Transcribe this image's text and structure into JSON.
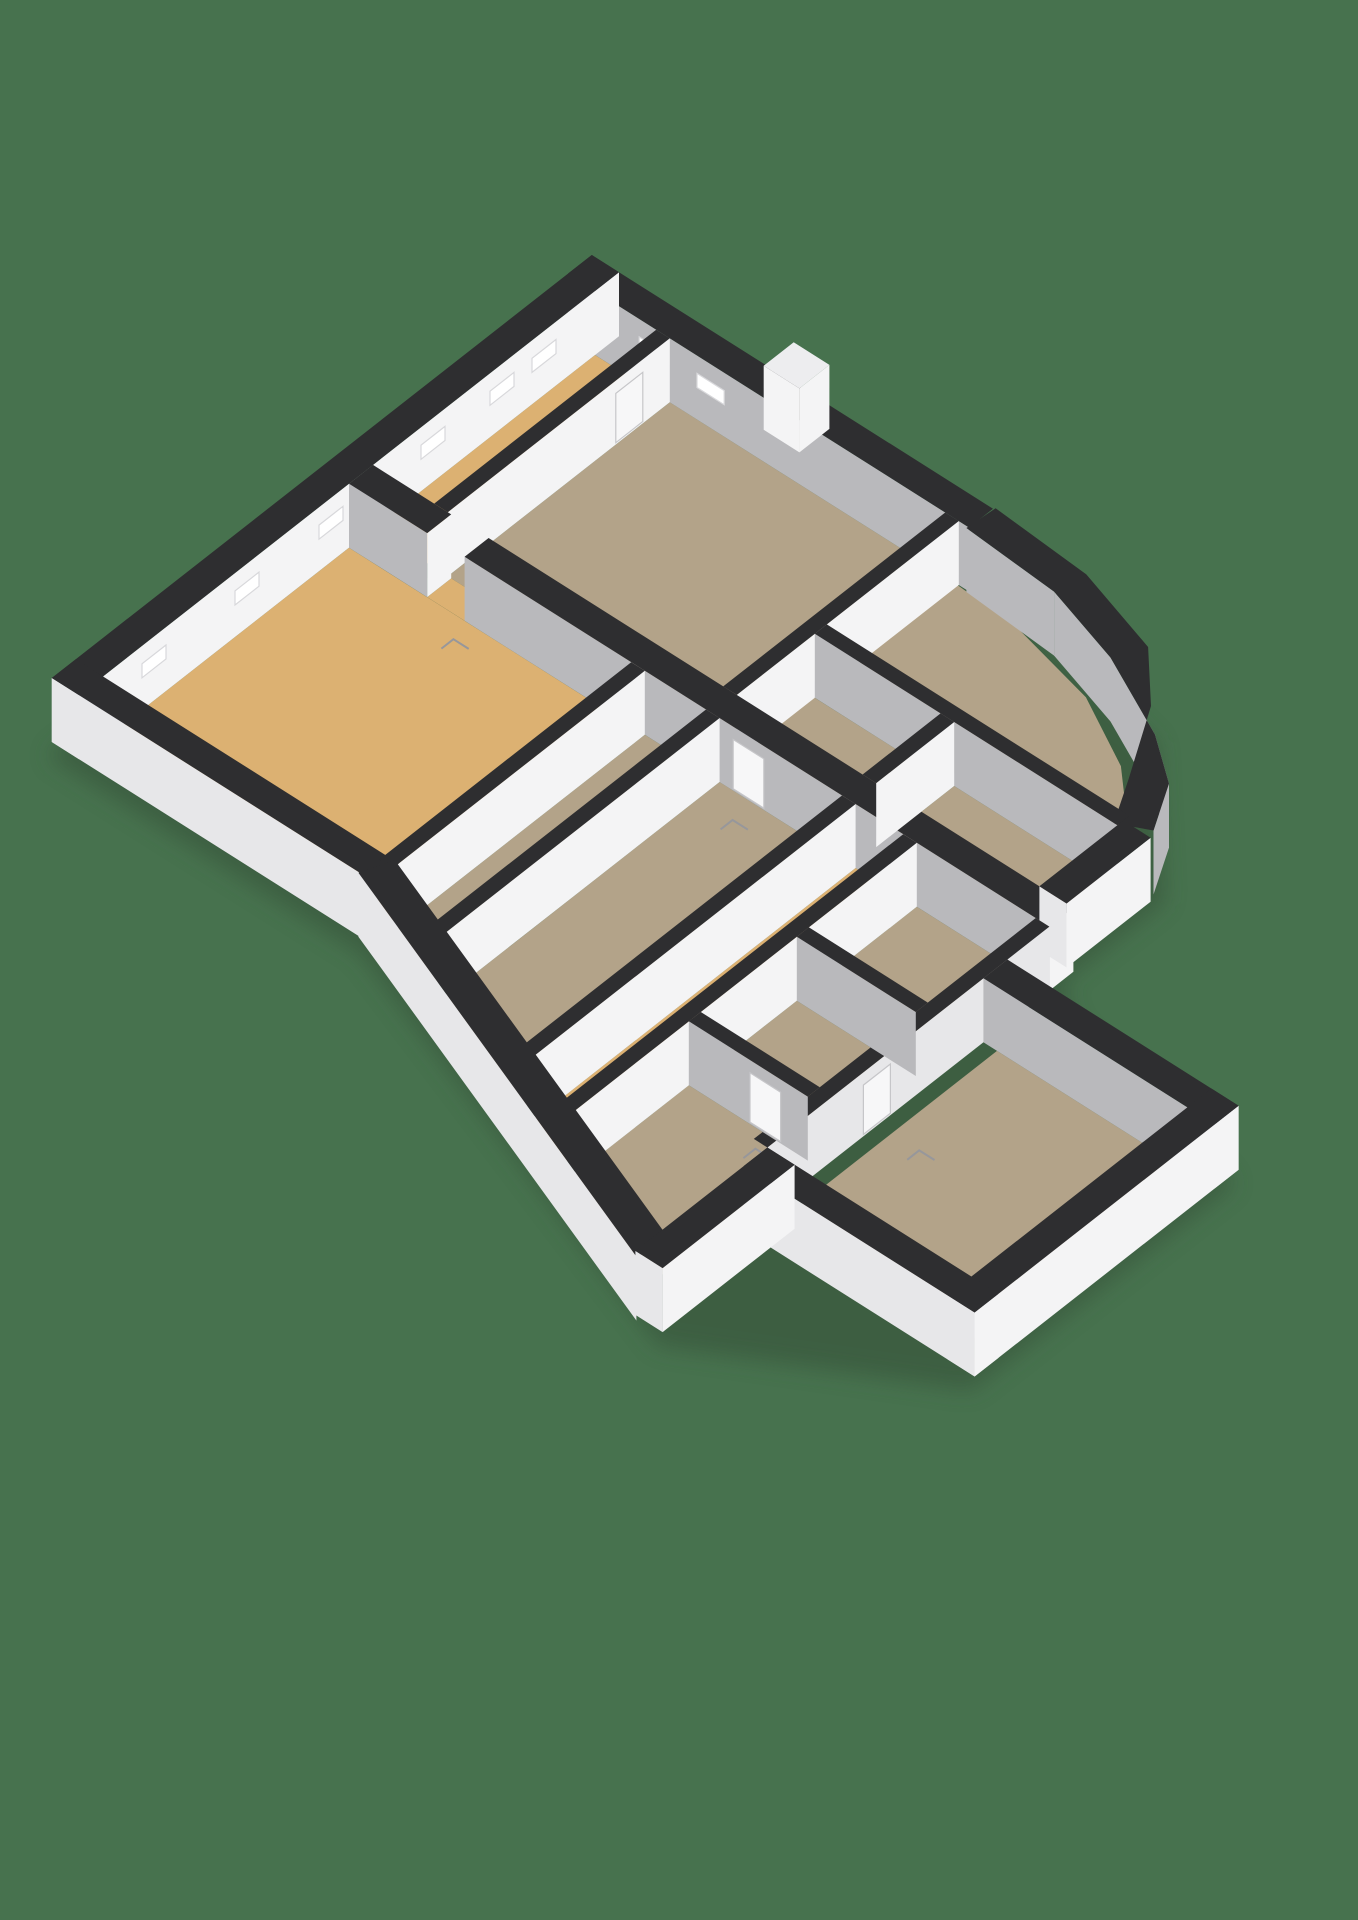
{
  "scene": {
    "description": "3D axonometric floor plan render on plain green background",
    "background_color": "#47724E",
    "shadow_color": "#344F39"
  },
  "palette": {
    "wall_cap": "#2E2E30",
    "wall_white": "#F4F4F5",
    "wall_exterior_light": "#E7E7E9",
    "wall_gray_inner": "#B9B9BC",
    "floor_tan": "#B3A389",
    "floor_gold": "#DCB172",
    "window_fill": "#FFFFFF",
    "window_stroke": "#D8D8DB",
    "door_fill": "#F7F7F8",
    "door_stroke": "#C6C6C9",
    "swing_mark": "#97979B",
    "fixture_fill": "#FCFCFC",
    "fixture_stroke": "#DCDCDE",
    "door_leaf_cap": "#EDEDEF"
  },
  "projection": {
    "origin": [
      595,
      355
    ],
    "axis_a": [
      34,
      21.5
    ],
    "axis_b": [
      -30,
      23.5
    ],
    "wall_height": 64,
    "shadow_offset": [
      -4,
      14
    ]
  },
  "shadow_footprint": [
    [
      -0.8,
      -0.8
    ],
    [
      11,
      -0.8
    ],
    [
      17,
      0.4
    ],
    [
      20.4,
      4
    ],
    [
      20.4,
      7.4
    ],
    [
      21.4,
      8.2
    ],
    [
      27.4,
      9.6
    ],
    [
      27.4,
      18.4
    ],
    [
      21.4,
      22.0
    ],
    [
      8.4,
      17.2
    ],
    [
      -0.8,
      17.2
    ]
  ],
  "floors": [
    {
      "name": "room-top-left",
      "color": "floor_gold",
      "pts": [
        [
          0,
          0
        ],
        [
          1.8,
          0
        ],
        [
          1.8,
          7.4
        ],
        [
          0,
          7.4
        ]
      ]
    },
    {
      "name": "room-top-center",
      "color": "floor_tan",
      "pts": [
        [
          2.2,
          0
        ],
        [
          10.4,
          0
        ],
        [
          10.4,
          7.4
        ],
        [
          2.2,
          7.4
        ]
      ]
    },
    {
      "name": "room-top-right",
      "color": "floor_tan",
      "pts": [
        [
          10.4,
          0
        ],
        [
          12.6,
          0.15
        ],
        [
          15.1,
          0.75
        ],
        [
          17.1,
          1.85
        ],
        [
          18.5,
          3.2
        ],
        [
          19.2,
          4.6
        ],
        [
          10.4,
          4.6
        ]
      ]
    },
    {
      "name": "room-upper-small-left",
      "color": "floor_tan",
      "pts": [
        [
          10.4,
          4.8
        ],
        [
          14.4,
          4.8
        ],
        [
          14.4,
          7.4
        ],
        [
          10.4,
          7.4
        ]
      ]
    },
    {
      "name": "room-upper-small-right",
      "color": "floor_tan",
      "pts": [
        [
          14.8,
          4.8
        ],
        [
          19.6,
          4.8
        ],
        [
          19.6,
          7.4
        ],
        [
          14.8,
          7.4
        ]
      ]
    },
    {
      "name": "door-gap-floor",
      "color": "floor_gold",
      "pts": [
        [
          2.3,
          7.4
        ],
        [
          3.4,
          7.4
        ],
        [
          3.4,
          8.2
        ],
        [
          2.3,
          8.2
        ]
      ]
    },
    {
      "name": "room-living-gold",
      "color": "floor_gold",
      "pts": [
        [
          0,
          8.2
        ],
        [
          8.5,
          8.2
        ],
        [
          8.5,
          16.5
        ],
        [
          0,
          16.5
        ]
      ]
    },
    {
      "name": "hall-strip",
      "color": "floor_tan",
      "pts": [
        [
          8.7,
          8.2
        ],
        [
          10.5,
          8.2
        ],
        [
          10.5,
          17.2
        ],
        [
          8.7,
          16.5
        ]
      ]
    },
    {
      "name": "room-long-strip",
      "color": "floor_tan",
      "pts": [
        [
          10.9,
          8.2
        ],
        [
          14.5,
          8.2
        ],
        [
          14.5,
          18.8
        ],
        [
          10.9,
          17.4
        ]
      ]
    },
    {
      "name": "corridor-gold",
      "color": "floor_gold",
      "pts": [
        [
          14.9,
          8.2
        ],
        [
          16.3,
          8.2
        ],
        [
          16.3,
          19.5
        ],
        [
          14.9,
          19.0
        ]
      ]
    },
    {
      "name": "room-mid-upper",
      "color": "floor_tan",
      "pts": [
        [
          16.7,
          8.2
        ],
        [
          20.2,
          8.2
        ],
        [
          20.2,
          11.8
        ],
        [
          16.7,
          11.8
        ]
      ]
    },
    {
      "name": "room-mid-lower",
      "color": "floor_tan",
      "pts": [
        [
          16.7,
          12.2
        ],
        [
          20.2,
          12.2
        ],
        [
          20.2,
          15.4
        ],
        [
          16.7,
          15.4
        ]
      ]
    },
    {
      "name": "room-bottom-left",
      "color": "floor_tan",
      "pts": [
        [
          16.7,
          15.8
        ],
        [
          20.2,
          15.8
        ],
        [
          20.2,
          21.1
        ],
        [
          16.7,
          19.7
        ]
      ]
    },
    {
      "name": "room-wing-big",
      "color": "floor_tan",
      "pts": [
        [
          21.0,
          10.4
        ],
        [
          26.6,
          10.4
        ],
        [
          26.6,
          17.6
        ],
        [
          21.0,
          17.6
        ]
      ]
    }
  ],
  "walls": [
    {
      "name": "exterior-northeast",
      "kind": "rect",
      "rect": [
        -0.8,
        -0.8,
        11,
        0
      ],
      "south": "wall_gray_inner",
      "east": null,
      "windows": [
        {
          "face": "south",
          "a1": 1.3,
          "a2": 2.1
        },
        {
          "face": "south",
          "a1": 3.0,
          "a2": 3.8
        }
      ]
    },
    {
      "name": "exterior-door-leaf",
      "kind": "rect",
      "rect": [
        4.3,
        -1.75,
        5.35,
        -0.75
      ],
      "south": "wall_white",
      "east": "wall_white",
      "cap": "door_leaf_cap"
    },
    {
      "name": "exterior-northwest",
      "kind": "rect",
      "rect": [
        -0.8,
        -0.8,
        0,
        17.2
      ],
      "south": "wall_exterior_light",
      "east": "wall_white",
      "windows": [
        {
          "face": "east",
          "a1": 1.3,
          "a2": 2.1
        },
        {
          "face": "east",
          "a1": 2.7,
          "a2": 3.5
        },
        {
          "face": "east",
          "a1": 5.0,
          "a2": 5.8
        },
        {
          "face": "east",
          "a1": 8.4,
          "a2": 9.2
        },
        {
          "face": "east",
          "a1": 11.2,
          "a2": 12.0
        },
        {
          "face": "east",
          "a1": 14.3,
          "a2": 15.1
        }
      ]
    },
    {
      "name": "exterior-curved-northeast",
      "kind": "path",
      "th": 0.9,
      "face": "wall_gray_inner",
      "pts": [
        [
          11,
          -0.4
        ],
        [
          13.8,
          -0.2
        ],
        [
          16.2,
          0.55
        ],
        [
          18.0,
          1.8
        ],
        [
          19.2,
          3.3
        ],
        [
          19.9,
          4.6
        ]
      ]
    },
    {
      "name": "exterior-east-upper",
      "kind": "rect",
      "rect": [
        19.6,
        4.6,
        20.4,
        7.4
      ],
      "south": "wall_exterior_light",
      "east": "wall_white"
    },
    {
      "name": "wall-top-left-divider",
      "kind": "rect",
      "rect": [
        1.8,
        0,
        2.2,
        7.4
      ],
      "south": null,
      "east": "wall_white",
      "doors": [
        {
          "face": "east",
          "a1": 0.9,
          "a2": 1.8
        }
      ]
    },
    {
      "name": "wall-top-center-divider",
      "kind": "rect",
      "rect": [
        10.3,
        0,
        10.7,
        7.4
      ],
      "south": null,
      "east": "wall_white"
    },
    {
      "name": "wall-topright-south",
      "kind": "rect",
      "rect": [
        10.7,
        4.4,
        19.6,
        4.8
      ],
      "south": "wall_gray_inner",
      "east": null
    },
    {
      "name": "wall-upper-small-divider",
      "kind": "rect",
      "rect": [
        14.4,
        4.8,
        14.8,
        7.4
      ],
      "south": null,
      "east": "wall_white"
    },
    {
      "name": "spine-west",
      "kind": "rect",
      "rect": [
        0,
        7.4,
        2.3,
        8.2
      ],
      "south": "wall_gray_inner",
      "east": "wall_white"
    },
    {
      "name": "spine-east",
      "kind": "rect",
      "rect": [
        3.4,
        7.4,
        20.6,
        8.2
      ],
      "south": "wall_gray_inner",
      "east": "wall_white",
      "doors": [
        {
          "face": "south",
          "a1": 11.3,
          "a2": 12.2
        }
      ]
    },
    {
      "name": "wall-gold-room-east",
      "kind": "rect",
      "rect": [
        8.3,
        8.2,
        8.7,
        16.6
      ],
      "south": null,
      "east": "wall_white"
    },
    {
      "name": "wall-hall-east",
      "kind": "rect",
      "rect": [
        10.5,
        8.2,
        10.9,
        17.3
      ],
      "south": null,
      "east": "wall_white"
    },
    {
      "name": "wall-strip-east",
      "kind": "rect",
      "rect": [
        14.5,
        8.2,
        14.9,
        18.9
      ],
      "south": null,
      "east": "wall_white"
    },
    {
      "name": "wall-corridor-east",
      "kind": "rect",
      "rect": [
        16.3,
        8.2,
        16.7,
        19.6
      ],
      "south": null,
      "east": "wall_white"
    },
    {
      "name": "wall-mid-divider-upper",
      "kind": "rect",
      "rect": [
        16.7,
        11.8,
        20.2,
        12.2
      ],
      "south": "wall_gray_inner",
      "east": null
    },
    {
      "name": "wall-mid-divider-lower",
      "kind": "rect",
      "rect": [
        16.7,
        15.4,
        20.2,
        15.8
      ],
      "south": "wall_gray_inner",
      "east": null,
      "doors": [
        {
          "face": "south",
          "a1": 18.5,
          "a2": 19.4
        }
      ]
    },
    {
      "name": "wall-cluster-east",
      "kind": "rect",
      "rect": [
        20.2,
        8.2,
        20.6,
        17.6
      ],
      "south": null,
      "east": "wall_exterior_light",
      "doors": [
        {
          "face": "east",
          "a1": 13.5,
          "a2": 14.4
        }
      ]
    },
    {
      "name": "wing-northeast",
      "kind": "rect",
      "rect": [
        20.6,
        9.6,
        27.4,
        10.4
      ],
      "south": "wall_gray_inner",
      "east": "wall_exterior_light"
    },
    {
      "name": "wing-east",
      "kind": "rect",
      "rect": [
        26.6,
        9.6,
        27.4,
        18.4
      ],
      "south": "wall_exterior_light",
      "east": "wall_white"
    },
    {
      "name": "wing-southwest",
      "kind": "rect",
      "rect": [
        20.6,
        17.6,
        27.4,
        18.4
      ],
      "south": "wall_exterior_light",
      "east": "wall_white"
    },
    {
      "name": "exterior-southeast-bottomleft",
      "kind": "rect",
      "rect": [
        20.6,
        17.6,
        21.4,
        22.0
      ],
      "south": "wall_exterior_light",
      "east": "wall_white"
    },
    {
      "name": "exterior-southwest",
      "kind": "rect",
      "rect": [
        -0.8,
        16.4,
        8.8,
        17.2
      ],
      "south": "wall_exterior_light",
      "east": null
    },
    {
      "name": "exterior-angled",
      "kind": "path",
      "th": 0.9,
      "face": "wall_exterior_light",
      "pts": [
        [
          8.4,
          16.8
        ],
        [
          20.9,
          21.7
        ]
      ]
    }
  ],
  "swing_marks": [
    [
      3.6,
      8.8
    ],
    [
      11.9,
      8.9
    ],
    [
      19.1,
      16.3
    ],
    [
      21.8,
      13.9
    ]
  ],
  "fixture": {
    "name": "toilet-fixture",
    "base": [
      15.45,
      13.85,
      16.05,
      14.35
    ],
    "lid": [
      15.55,
      14.0,
      15.9,
      14.28
    ]
  }
}
